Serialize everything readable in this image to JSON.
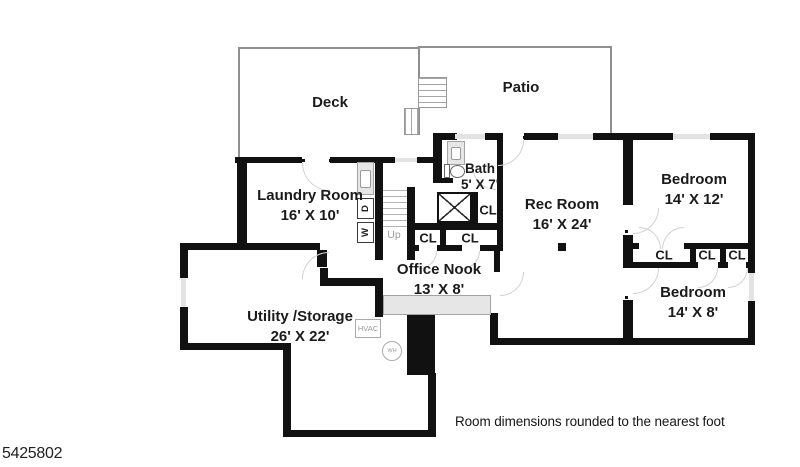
{
  "page": {
    "footer_note": "Room dimensions rounded to the nearest foot",
    "listing_id": "5425802"
  },
  "outdoor": {
    "deck_label": "Deck",
    "patio_label": "Patio"
  },
  "rooms": {
    "laundry": {
      "name": "Laundry Room",
      "dims": "16' X 10'"
    },
    "bath": {
      "name": "Bath",
      "dims": "5' X 7'"
    },
    "rec": {
      "name": "Rec Room",
      "dims": "16' X 24'"
    },
    "bedroom1": {
      "name": "Bedroom",
      "dims": "14' X 12'"
    },
    "bedroom2": {
      "name": "Bedroom",
      "dims": "14' X 8'"
    },
    "office": {
      "name": "Office Nook",
      "dims": "13' X 8'"
    },
    "utility": {
      "name": "Utility /Storage",
      "dims": "26' X 22'"
    }
  },
  "labels": {
    "closet": "CL",
    "stairs_up": "Up",
    "hvac": "HVAC",
    "water_heater": "WH",
    "washer": "W",
    "dryer": "D"
  },
  "colors": {
    "wall": "#111111",
    "outdoor_line": "#8f8f8f",
    "window_fill": "#e3e3e3",
    "door_arc": "#d2d2d2",
    "muted_text": "#9a9a9a",
    "text": "#1b1b1b"
  }
}
